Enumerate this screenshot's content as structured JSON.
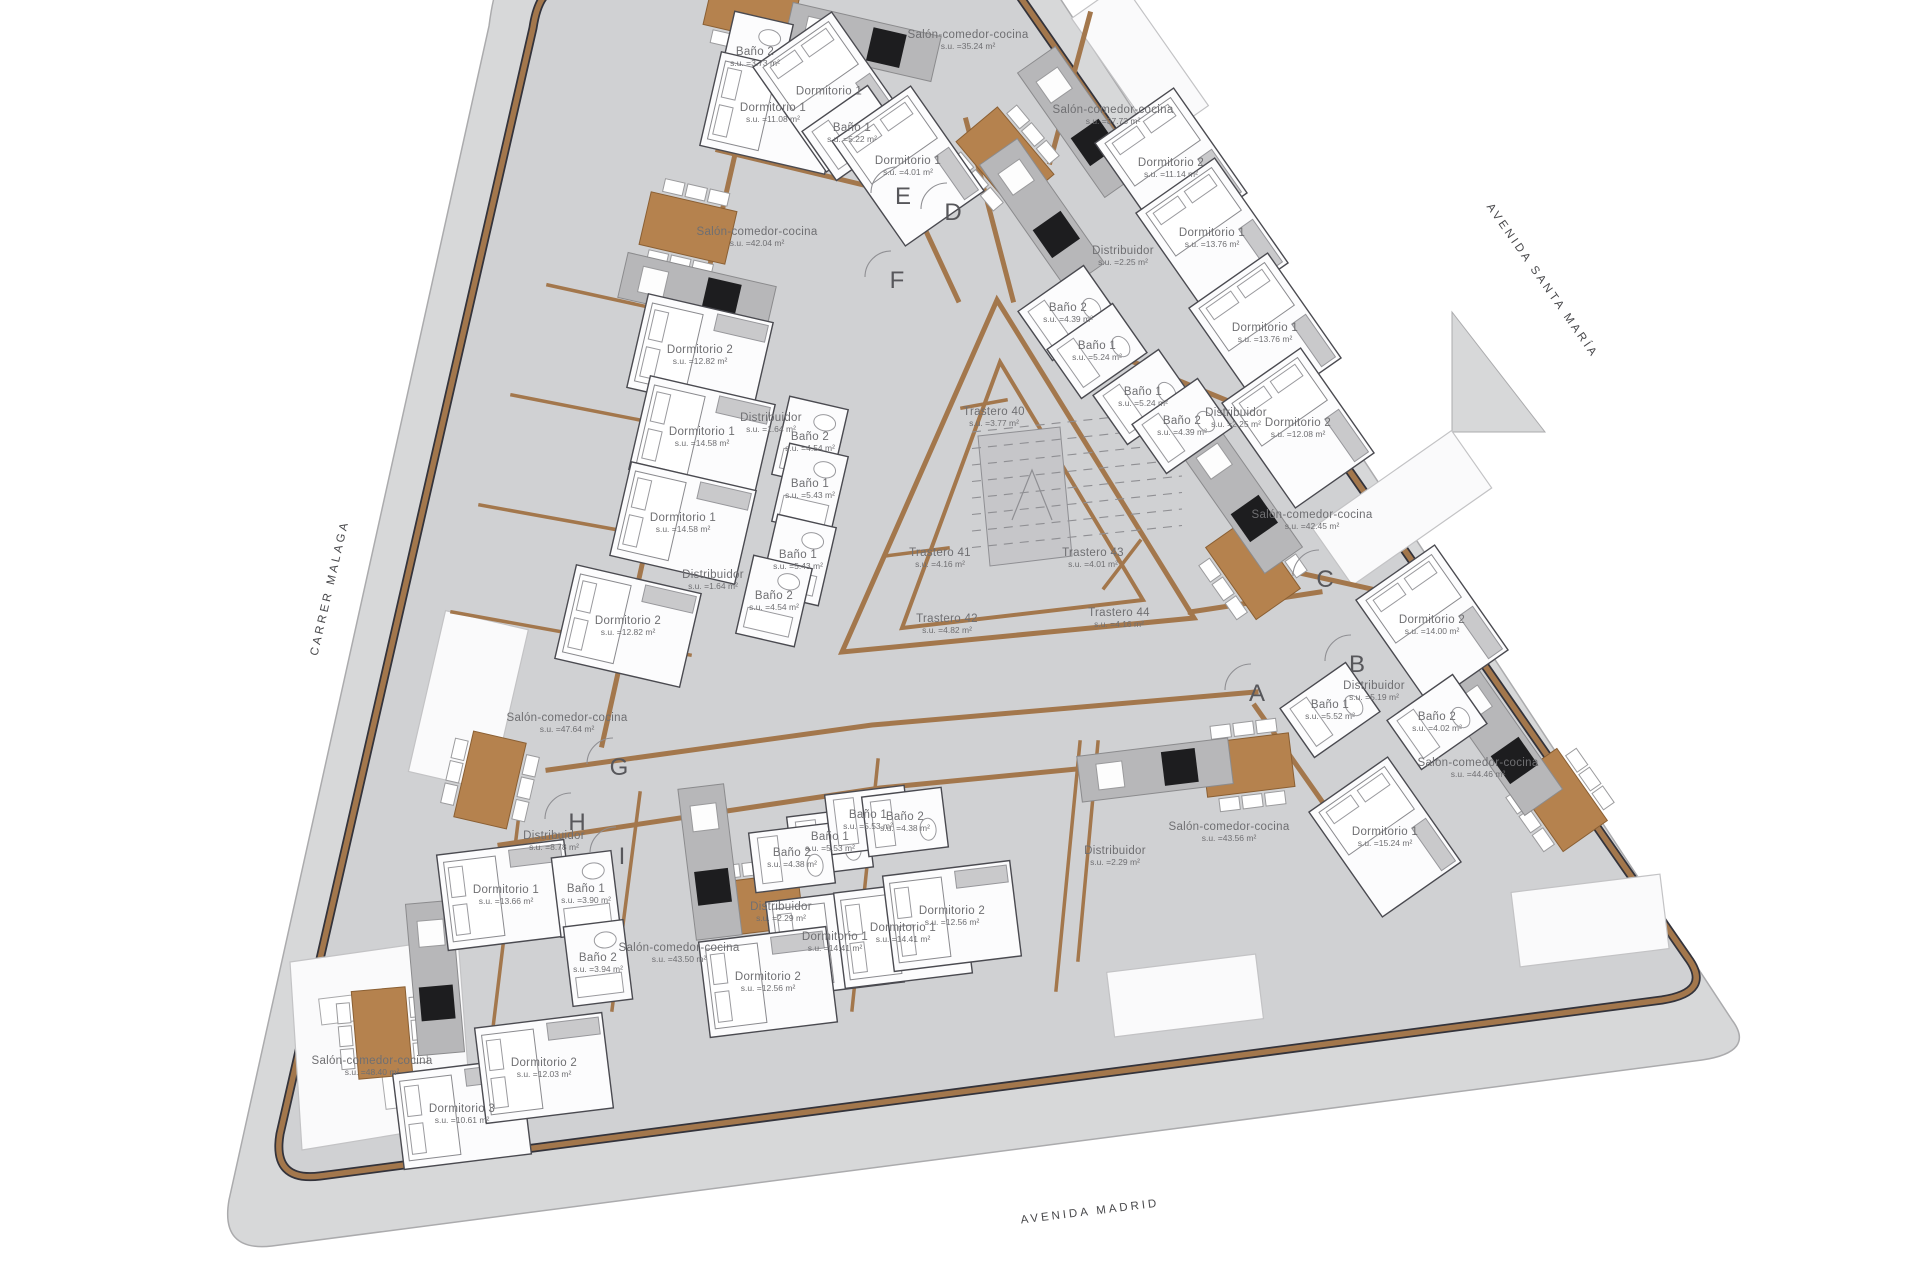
{
  "title": "Planta - plano de distribución",
  "colors": {
    "site": "#d7d8d9",
    "building": "#d0d1d3",
    "wall_brown": "#a3774c",
    "wall_dark": "#33333b",
    "room_white": "#fcfcfd",
    "stair_gray": "#c6c6c9",
    "island_gray": "#b7b7b9",
    "stove_black": "#1d1d1f",
    "table_wood": "#b5824e",
    "label_text": "#6f6f72",
    "street_text": "#47474a"
  },
  "streets": {
    "left": "CARRER MALAGA",
    "bottom": "AVENIDA MADRID",
    "right": "AVENIDA SANTA MARÍA"
  },
  "entrances": [
    {
      "letter": "A",
      "x": 1257,
      "y": 694
    },
    {
      "letter": "B",
      "x": 1357,
      "y": 665
    },
    {
      "letter": "C",
      "x": 1325,
      "y": 580
    },
    {
      "letter": "D",
      "x": 953,
      "y": 213
    },
    {
      "letter": "E",
      "x": 903,
      "y": 197
    },
    {
      "letter": "F",
      "x": 897,
      "y": 281
    },
    {
      "letter": "G",
      "x": 619,
      "y": 768
    },
    {
      "letter": "H",
      "x": 577,
      "y": 823
    },
    {
      "letter": "I",
      "x": 622,
      "y": 857
    }
  ],
  "rooms": [
    {
      "n": "Baño 2",
      "a": "s.u. =3.73 m²",
      "x": 755,
      "y": 57,
      "r": 13,
      "t": "bath"
    },
    {
      "n": "Dormitorio 1",
      "a": "s.u. =11.08 m²",
      "x": 773,
      "y": 113,
      "r": 13,
      "t": "dorm"
    },
    {
      "n": "Dormitorio 1",
      "a": "",
      "x": 829,
      "y": 92,
      "r": 55,
      "t": "dorm"
    },
    {
      "n": "Baño 1",
      "a": "s.u. =5.22 m²",
      "x": 852,
      "y": 133,
      "r": 55,
      "t": "bath"
    },
    {
      "n": "Dormitorio 1",
      "a": "s.u. =4.01 m²",
      "x": 908,
      "y": 166,
      "r": 55,
      "t": "dorm"
    },
    {
      "n": "Salón-comedor-cocina",
      "a": "s.u. =35.24 m²",
      "x": 968,
      "y": 40,
      "r": 55,
      "t": "salon"
    },
    {
      "n": "Salón-comedor-cocina",
      "a": "s.u. =42.04 m²",
      "x": 757,
      "y": 237,
      "r": 13,
      "t": "salon"
    },
    {
      "n": "Salón-comedor-cocina",
      "a": "s.u. =37.73 m²",
      "x": 1113,
      "y": 115,
      "r": 55,
      "t": "salon"
    },
    {
      "n": "Dormitorio 2",
      "a": "s.u. =11.14 m²",
      "x": 1171,
      "y": 168,
      "r": 55,
      "t": "dorm"
    },
    {
      "n": "Dormitorio 1",
      "a": "s.u. =13.76 m²",
      "x": 1212,
      "y": 238,
      "r": 55,
      "t": "dorm"
    },
    {
      "n": "Distribuidor",
      "a": "s.u. =2.25 m²",
      "x": 1123,
      "y": 256,
      "r": 55,
      "t": "dist"
    },
    {
      "n": "Baño 2",
      "a": "s.u. =4.39 m²",
      "x": 1068,
      "y": 313,
      "r": 55,
      "t": "bath"
    },
    {
      "n": "Baño 1",
      "a": "s.u. =5.24 m²",
      "x": 1097,
      "y": 351,
      "r": 55,
      "t": "bath"
    },
    {
      "n": "Dormitorio 1",
      "a": "s.u. =13.76 m²",
      "x": 1265,
      "y": 333,
      "r": 55,
      "t": "dorm"
    },
    {
      "n": "Baño 1",
      "a": "s.u. =5.24 m²",
      "x": 1143,
      "y": 397,
      "r": 55,
      "t": "bath"
    },
    {
      "n": "Baño 2",
      "a": "s.u. =4.39 m²",
      "x": 1182,
      "y": 426,
      "r": 55,
      "t": "bath"
    },
    {
      "n": "Distribuidor",
      "a": "s.u. =2.25 m²",
      "x": 1236,
      "y": 418,
      "r": 55,
      "t": "dist"
    },
    {
      "n": "Dormitorio 2",
      "a": "s.u. =12.08 m²",
      "x": 1298,
      "y": 428,
      "r": 55,
      "t": "dorm"
    },
    {
      "n": "Salón-comedor-cocina",
      "a": "s.u. =42.45 m²",
      "x": 1312,
      "y": 520,
      "r": 55,
      "t": "salon"
    },
    {
      "n": "Dormitorio 2",
      "a": "s.u. =12.82 m²",
      "x": 700,
      "y": 355,
      "r": 13,
      "t": "dorm"
    },
    {
      "n": "Distribuidor",
      "a": "s.u. =1.64 m²",
      "x": 771,
      "y": 423,
      "r": 13,
      "t": "dist"
    },
    {
      "n": "Baño 2",
      "a": "s.u. =4.54 m²",
      "x": 810,
      "y": 442,
      "r": 13,
      "t": "bath"
    },
    {
      "n": "Dormitorio 1",
      "a": "s.u. =14.58 m²",
      "x": 702,
      "y": 437,
      "r": 13,
      "t": "dorm"
    },
    {
      "n": "Baño 1",
      "a": "s.u. =5.43 m²",
      "x": 810,
      "y": 489,
      "r": 13,
      "t": "bath"
    },
    {
      "n": "Dormitorio 1",
      "a": "s.u. =14.58 m²",
      "x": 683,
      "y": 523,
      "r": 13,
      "t": "dorm"
    },
    {
      "n": "Baño 1",
      "a": "s.u. =5.43 m²",
      "x": 798,
      "y": 560,
      "r": 13,
      "t": "bath"
    },
    {
      "n": "Distribuidor",
      "a": "s.u. =1.64 m²",
      "x": 713,
      "y": 580,
      "r": 13,
      "t": "dist"
    },
    {
      "n": "Baño 2",
      "a": "s.u. =4.54 m²",
      "x": 774,
      "y": 601,
      "r": 13,
      "t": "bath"
    },
    {
      "n": "Dormitorio 2",
      "a": "s.u. =12.82 m²",
      "x": 628,
      "y": 626,
      "r": 13,
      "t": "dorm"
    },
    {
      "n": "Salón-comedor-cocina",
      "a": "s.u. =47.64 m²",
      "x": 567,
      "y": 723,
      "r": 13,
      "t": "salon"
    },
    {
      "n": "Trastero 40",
      "a": "s.u. =3.77 m²",
      "x": 994,
      "y": 417,
      "r": 0,
      "t": "trastero"
    },
    {
      "n": "Trastero 41",
      "a": "s.u. =4.16 m²",
      "x": 940,
      "y": 558,
      "r": 0,
      "t": "trastero"
    },
    {
      "n": "Trastero 42",
      "a": "s.u. =4.82 m²",
      "x": 947,
      "y": 624,
      "r": 0,
      "t": "trastero"
    },
    {
      "n": "Trastero 43",
      "a": "s.u. =4.01 m²",
      "x": 1093,
      "y": 558,
      "r": 0,
      "t": "trastero"
    },
    {
      "n": "Trastero 44",
      "a": "s.u. =4.16 m²",
      "x": 1119,
      "y": 618,
      "r": 0,
      "t": "trastero"
    },
    {
      "n": "Dormitorio 2",
      "a": "s.u. =14.00 m²",
      "x": 1432,
      "y": 625,
      "r": 55,
      "t": "dorm"
    },
    {
      "n": "Distribuidor",
      "a": "s.u. =5.19 m²",
      "x": 1374,
      "y": 691,
      "r": 55,
      "t": "dist"
    },
    {
      "n": "Baño 1",
      "a": "s.u. =5.52 m²",
      "x": 1330,
      "y": 710,
      "r": 55,
      "t": "bath"
    },
    {
      "n": "Baño 2",
      "a": "s.u. =4.02 m²",
      "x": 1437,
      "y": 722,
      "r": 55,
      "t": "bath"
    },
    {
      "n": "Salón-comedor-cocina",
      "a": "s.u. =44.46 m²",
      "x": 1478,
      "y": 768,
      "r": 55,
      "t": "salon"
    },
    {
      "n": "Dormitorio 1",
      "a": "s.u. =15.24 m²",
      "x": 1385,
      "y": 837,
      "r": 55,
      "t": "dorm"
    },
    {
      "n": "Salón-comedor-cocina",
      "a": "s.u. =43.56 m²",
      "x": 1229,
      "y": 832,
      "r": -7,
      "t": "salon"
    },
    {
      "n": "Distribuidor",
      "a": "s.u. =2.29 m²",
      "x": 1115,
      "y": 856,
      "r": -7,
      "t": "dist"
    },
    {
      "n": "Distribuidor",
      "a": "s.u. =8.78 m²",
      "x": 554,
      "y": 841,
      "r": -7,
      "t": "dist"
    },
    {
      "n": "Dormitorio 1",
      "a": "s.u. =13.66 m²",
      "x": 506,
      "y": 895,
      "r": -7,
      "t": "dorm"
    },
    {
      "n": "Baño 1",
      "a": "s.u. =3.90 m²",
      "x": 586,
      "y": 894,
      "r": -7,
      "t": "bath"
    },
    {
      "n": "Baño 2",
      "a": "s.u. =3.94 m²",
      "x": 598,
      "y": 963,
      "r": -7,
      "t": "bath"
    },
    {
      "n": "Salón-comedor-cocina",
      "a": "s.u. =43.50 m²",
      "x": 679,
      "y": 953,
      "r": -7,
      "t": "salon"
    },
    {
      "n": "Baño 1",
      "a": "s.u. =5.53 m²",
      "x": 830,
      "y": 842,
      "r": 83,
      "t": "bath"
    },
    {
      "n": "Baño 2",
      "a": "s.u. =4.38 m²",
      "x": 792,
      "y": 858,
      "r": 83,
      "t": "bath"
    },
    {
      "n": "Baño 1",
      "a": "s.u. =5.53 m²",
      "x": 868,
      "y": 820,
      "r": 83,
      "t": "bath"
    },
    {
      "n": "Baño 2",
      "a": "s.u. =4.38 m²",
      "x": 905,
      "y": 822,
      "r": 83,
      "t": "bath"
    },
    {
      "n": "Distribuidor",
      "a": "s.u. =2.29 m²",
      "x": 781,
      "y": 912,
      "r": -7,
      "t": "dist"
    },
    {
      "n": "Dormitorio 1",
      "a": "s.u. =14.41 m²",
      "x": 835,
      "y": 942,
      "r": -7,
      "t": "dorm"
    },
    {
      "n": "Dormitorio 2",
      "a": "s.u. =12.56 m²",
      "x": 768,
      "y": 982,
      "r": -7,
      "t": "dorm"
    },
    {
      "n": "Dormitorio 1",
      "a": "s.u. =14.41 m²",
      "x": 903,
      "y": 933,
      "r": -7,
      "t": "dorm"
    },
    {
      "n": "Dormitorio 2",
      "a": "s.u. =12.56 m²",
      "x": 952,
      "y": 916,
      "r": -7,
      "t": "dorm"
    },
    {
      "n": "Salón-comedor-cocina",
      "a": "s.u. =48.40 m²",
      "x": 372,
      "y": 1066,
      "r": -7,
      "t": "salon"
    },
    {
      "n": "Dormitorio 3",
      "a": "s.u. =10.61 m²",
      "x": 462,
      "y": 1114,
      "r": -7,
      "t": "dorm"
    },
    {
      "n": "Dormitorio 2",
      "a": "s.u. =12.03 m²",
      "x": 544,
      "y": 1068,
      "r": -7,
      "t": "dorm"
    }
  ]
}
